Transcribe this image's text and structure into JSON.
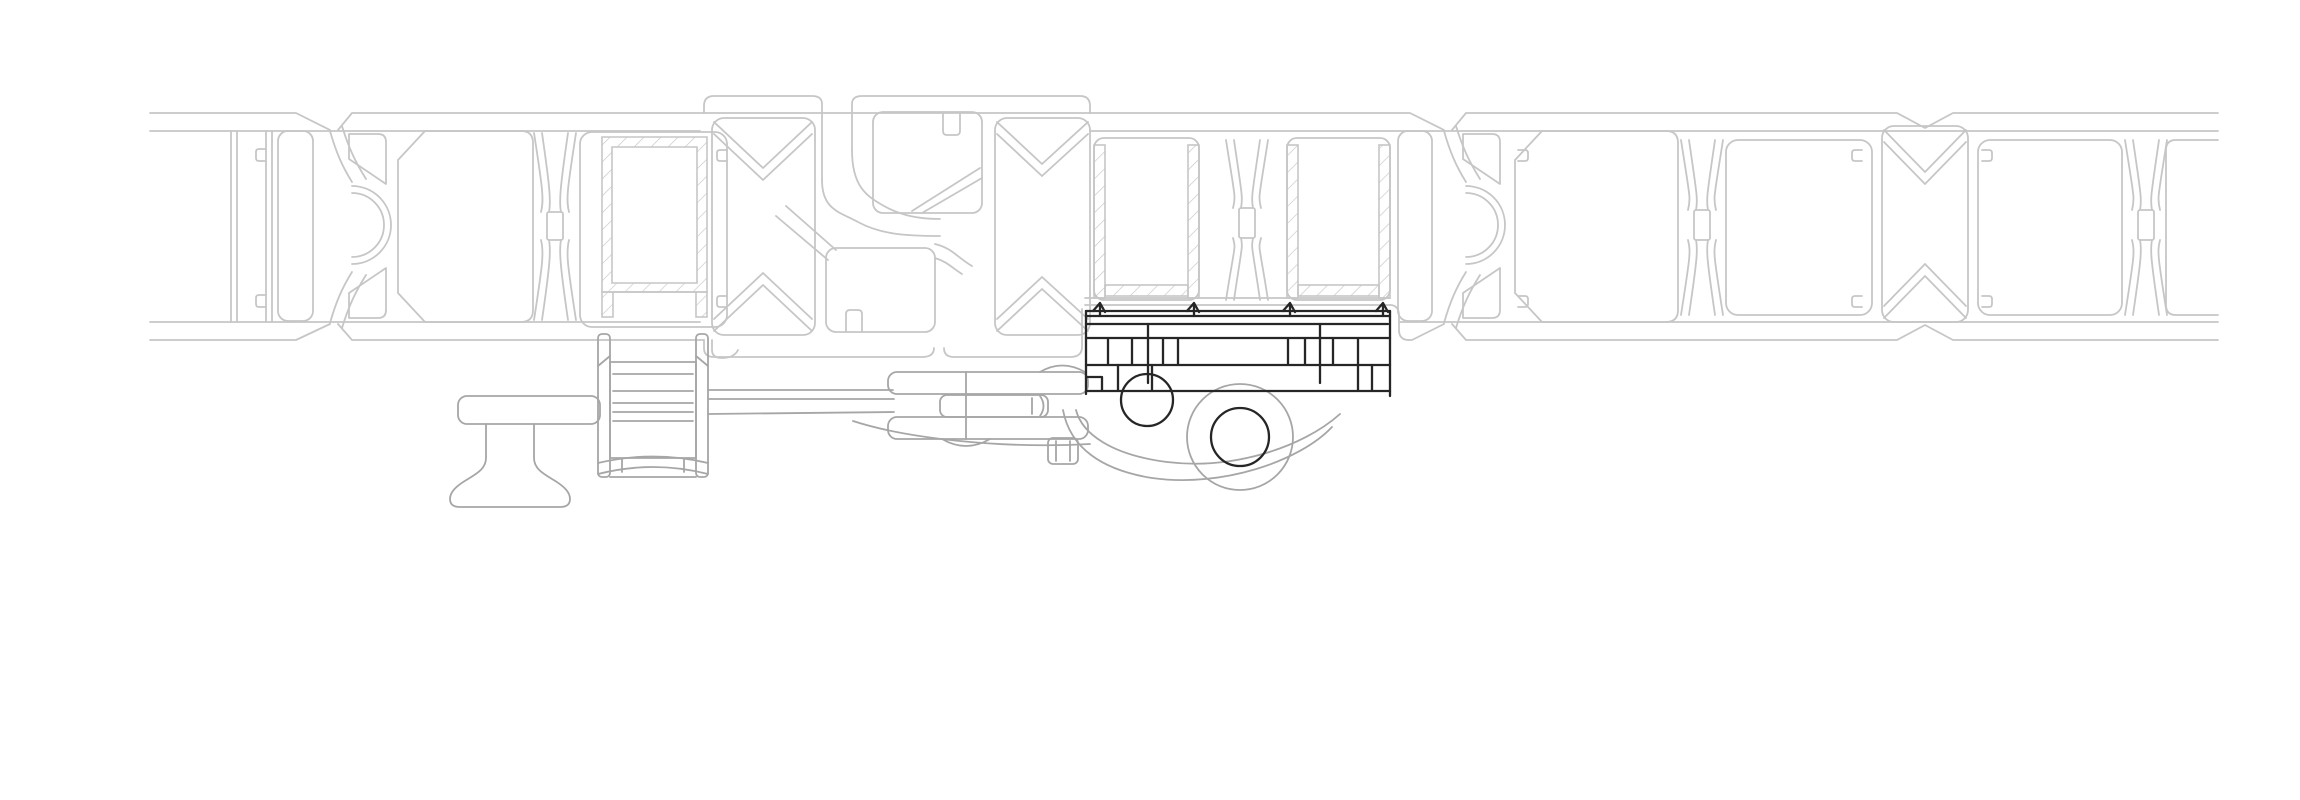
{
  "page": {
    "title": "",
    "background": "#ffffff",
    "width_px": 2300,
    "height_px": 800
  },
  "drawing": {
    "kind": "cad-line-drawing",
    "subject": "Horizontal cross-section of a multi-chamber PVC sliding window/door profile system with tilt-and-slide roller hardware",
    "orientation": "horizontal profile band across upper half of canvas, hardware hanging below center, lower half blank",
    "colors": {
      "profile": "#c6c6c6",
      "hardware": "#a6a6a6",
      "dark": "#262626",
      "background": "#ffffff"
    },
    "components": [
      {
        "name": "frame-profile-left",
        "description": "multi-chamber frame profile with open cut left end"
      },
      {
        "name": "gasket-junction-left",
        "description": "S-shaped co-extruded seal junction with round bulb and chamfered blocks"
      },
      {
        "name": "hourglass-strut",
        "description": "pinched double-wall strut with small center box (4 instances)"
      },
      {
        "name": "steel-reinforcement",
        "description": "hatched C-channel steel insert inside chamber"
      },
      {
        "name": "meeting-stile",
        "description": "raised interlock section with two caps, notched square chambers, diagonal braces and stepped S-channel"
      },
      {
        "name": "sash-profile-with-rollers",
        "description": "sash section with hatched steel chamber walls above the roller carriage"
      },
      {
        "name": "roller-carriage",
        "description": "dark bogie carriage clipped under sash with fixing pins"
      },
      {
        "name": "roller-wheel-small",
        "description": "small guide roller"
      },
      {
        "name": "roller-wheel-large",
        "description": "large running roller with outer ring"
      },
      {
        "name": "support-arm",
        "description": "curved swing arm sweeping under the carriage"
      },
      {
        "name": "handle-knob",
        "description": "mushroom shaped knob on flat bar"
      },
      {
        "name": "adjustment-block",
        "description": "ribbed sliding block with arched clip at bottom"
      },
      {
        "name": "linkage-arm",
        "description": "long flat arm connecting block to hinge"
      },
      {
        "name": "hinge-pivot",
        "description": "flat scissor hinge with pivot pin, bracket and foot"
      },
      {
        "name": "gasket-junction-right",
        "description": "mirrored S-shaped seal junction"
      },
      {
        "name": "frame-profile-right",
        "description": "multi-chamber frame profile with V-strut chamber and open cut right end"
      }
    ]
  }
}
